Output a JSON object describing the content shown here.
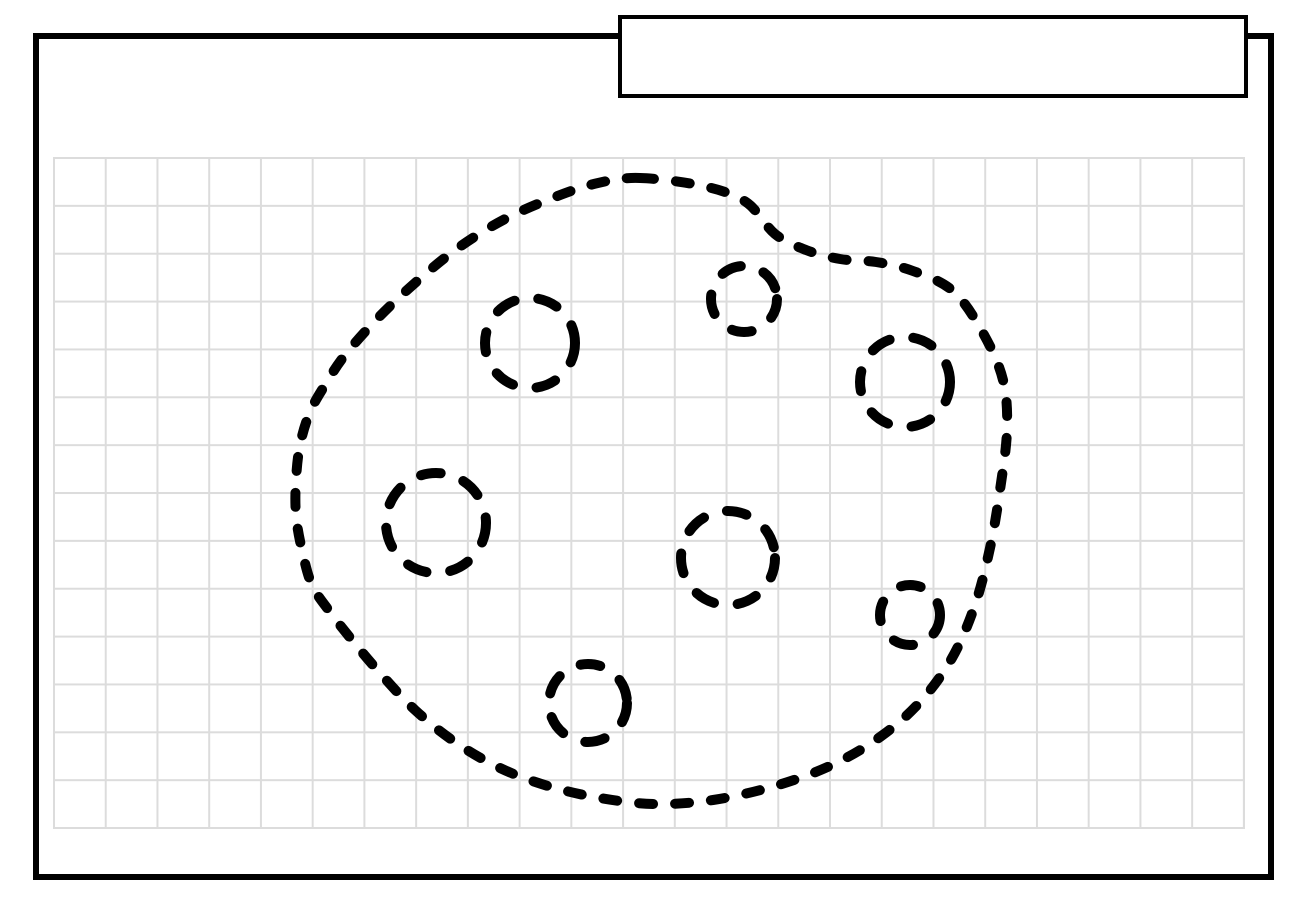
{
  "colors": {
    "ink": "#000000",
    "grid_line": "#dcdcdc",
    "background": "#ffffff"
  },
  "grid": {
    "left": 53,
    "top": 157,
    "width": 1192,
    "height": 672,
    "cell_width": 51.74,
    "cell_height": 47.86,
    "line_thickness": 2
  },
  "drawing": {
    "description": "hand-drawn dashed cookie-like blob outline with seven dashed chip circles",
    "stroke_width": 10,
    "blob_dash": "14 22",
    "circle_dash": "20 24",
    "blob_points": [
      [
        640,
        178
      ],
      [
        703,
        186
      ],
      [
        746,
        202
      ],
      [
        775,
        234
      ],
      [
        806,
        250
      ],
      [
        840,
        259
      ],
      [
        876,
        262
      ],
      [
        913,
        271
      ],
      [
        953,
        291
      ],
      [
        983,
        333
      ],
      [
        1003,
        380
      ],
      [
        1007,
        430
      ],
      [
        1000,
        490
      ],
      [
        990,
        548
      ],
      [
        975,
        605
      ],
      [
        952,
        658
      ],
      [
        920,
        702
      ],
      [
        880,
        737
      ],
      [
        832,
        765
      ],
      [
        775,
        786
      ],
      [
        713,
        800
      ],
      [
        655,
        804
      ],
      [
        600,
        798
      ],
      [
        548,
        786
      ],
      [
        500,
        768
      ],
      [
        455,
        742
      ],
      [
        415,
        710
      ],
      [
        380,
        673
      ],
      [
        352,
        640
      ],
      [
        330,
        612
      ],
      [
        312,
        585
      ],
      [
        302,
        550
      ],
      [
        296,
        515
      ],
      [
        296,
        480
      ],
      [
        300,
        445
      ],
      [
        310,
        412
      ],
      [
        325,
        385
      ],
      [
        345,
        355
      ],
      [
        378,
        318
      ],
      [
        415,
        283
      ],
      [
        458,
        248
      ],
      [
        505,
        219
      ],
      [
        555,
        197
      ],
      [
        598,
        183
      ]
    ],
    "circles": [
      {
        "cx": 530,
        "cy": 343,
        "r": 45
      },
      {
        "cx": 744,
        "cy": 299,
        "r": 33
      },
      {
        "cx": 905,
        "cy": 382,
        "r": 45
      },
      {
        "cx": 436,
        "cy": 523,
        "r": 50
      },
      {
        "cx": 728,
        "cy": 558,
        "r": 47
      },
      {
        "cx": 910,
        "cy": 615,
        "r": 30
      },
      {
        "cx": 588,
        "cy": 703,
        "r": 39
      }
    ]
  }
}
